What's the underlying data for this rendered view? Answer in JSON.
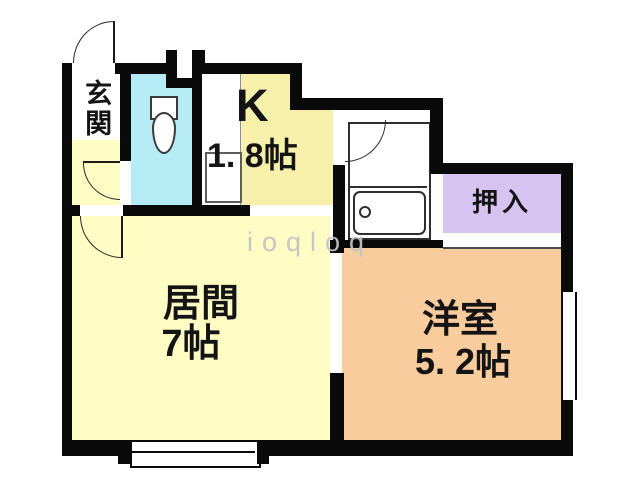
{
  "floorplan": {
    "type": "japanese-apartment-floorplan",
    "rooms": {
      "genkan": {
        "label": "玄関"
      },
      "kitchen": {
        "label": "K",
        "size": "1. 8帖"
      },
      "living": {
        "label": "居間",
        "size": "7帖"
      },
      "western": {
        "label": "洋室",
        "size": "5. 2帖"
      },
      "closet": {
        "label": "押入"
      },
      "toilet": {
        "label": ""
      },
      "bathroom": {
        "label": ""
      }
    },
    "fixtures": [
      "toilet-bowl",
      "kitchen-sink",
      "bathtub"
    ],
    "watermark": "ioqloq",
    "colors": {
      "wall": "#0a0a0a",
      "living_hall_yellow": "#FFFCC4",
      "kitchen_yellow": "#F6F0AB",
      "toilet_cyan": "#B5EBF4",
      "closet_purple": "#D6C3F0",
      "western_peach": "#F8CC9C",
      "watermark_gray": "#C3C3C3"
    }
  }
}
